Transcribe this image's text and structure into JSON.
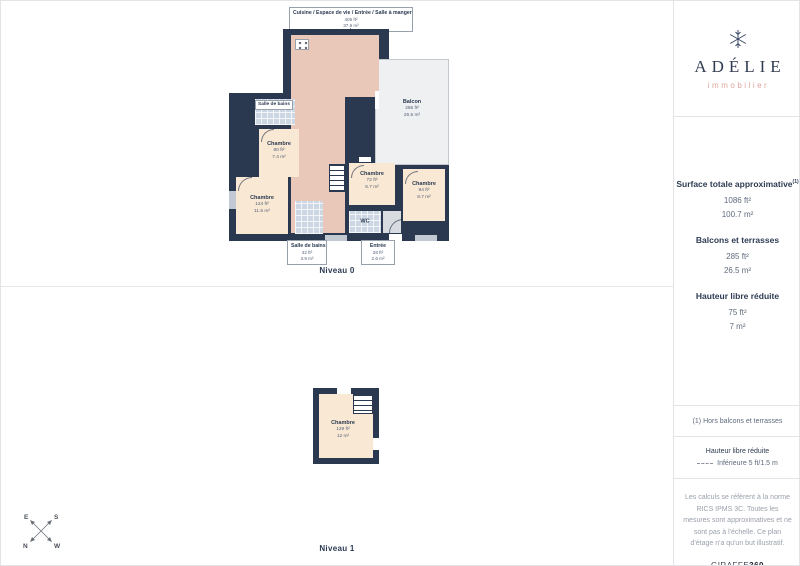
{
  "brand": {
    "name": "ADÉLIE",
    "tagline": "immobilier"
  },
  "levels": {
    "level0": "Niveau 0",
    "level1": "Niveau 1"
  },
  "plan0": {
    "callout_top": {
      "title": "Cuisine / Espace de vie / Entrée / Salle à manger",
      "ft": "405 ft²",
      "m": "37.6 m²"
    },
    "rooms": {
      "bath1": {
        "name": "Salle de bains"
      },
      "chambre1": {
        "name": "Chambre",
        "ft": "80 ft²",
        "m": "7.4 m²"
      },
      "chambre2": {
        "name": "Chambre",
        "ft": "124 ft²",
        "m": "11.5 m²"
      },
      "chambre3": {
        "name": "Chambre",
        "ft": "72 ft²",
        "m": "6.7 m²"
      },
      "chambre4": {
        "name": "Chambre",
        "ft": "94 ft²",
        "m": "8.7 m²"
      },
      "balcon": {
        "name": "Balcon",
        "ft": "285 ft²",
        "m": "26.5 m²"
      },
      "wc": {
        "name": "WC"
      }
    },
    "callout_bath": {
      "title": "Salle de bains",
      "ft": "42 ft²",
      "m": "3.9 m²"
    },
    "callout_entree": {
      "title": "Entrée",
      "ft": "28 ft²",
      "m": "2.6 m²"
    }
  },
  "plan1": {
    "room": {
      "name": "Chambre",
      "ft": "129 ft²",
      "m": "12 m²"
    }
  },
  "sidebar": {
    "surface": {
      "heading": "Surface totale approximative",
      "heading_sup": "(1)",
      "ft": "1086 ft²",
      "m": "100.7 m²"
    },
    "balconies": {
      "heading": "Balcons et terrasses",
      "ft": "285 ft²",
      "m": "26.5 m²"
    },
    "reduced_height": {
      "heading": "Hauteur libre réduite",
      "ft": "75 ft²",
      "m": "7 m²"
    },
    "footnote": "(1) Hors balcons et terrasses",
    "legend": {
      "heading": "Hauteur libre réduite",
      "value": "Inférieure 5 ft/1.5 m"
    },
    "disclaimer": "Les calculs se réfèrent à la norme RICS IPMS 3C. Toutes les mesures sont approximatives et ne sont pas à l'échelle. Ce plan d'étage n'a qu'un but illustratif.",
    "watermark_part1": "GIRAFFE",
    "watermark_part2": "360"
  },
  "compass": {
    "top_left": "E",
    "top_right": "S",
    "bottom_left": "N",
    "bottom_right": "W"
  },
  "colors": {
    "wall": "#2b3950",
    "living": "#e9c8b9",
    "bedroom": "#f9e8d3",
    "tile": "#ccd7e3",
    "balcony": "#eef0f1",
    "brand_navy": "#323c52",
    "brand_pink": "#dba49a"
  }
}
